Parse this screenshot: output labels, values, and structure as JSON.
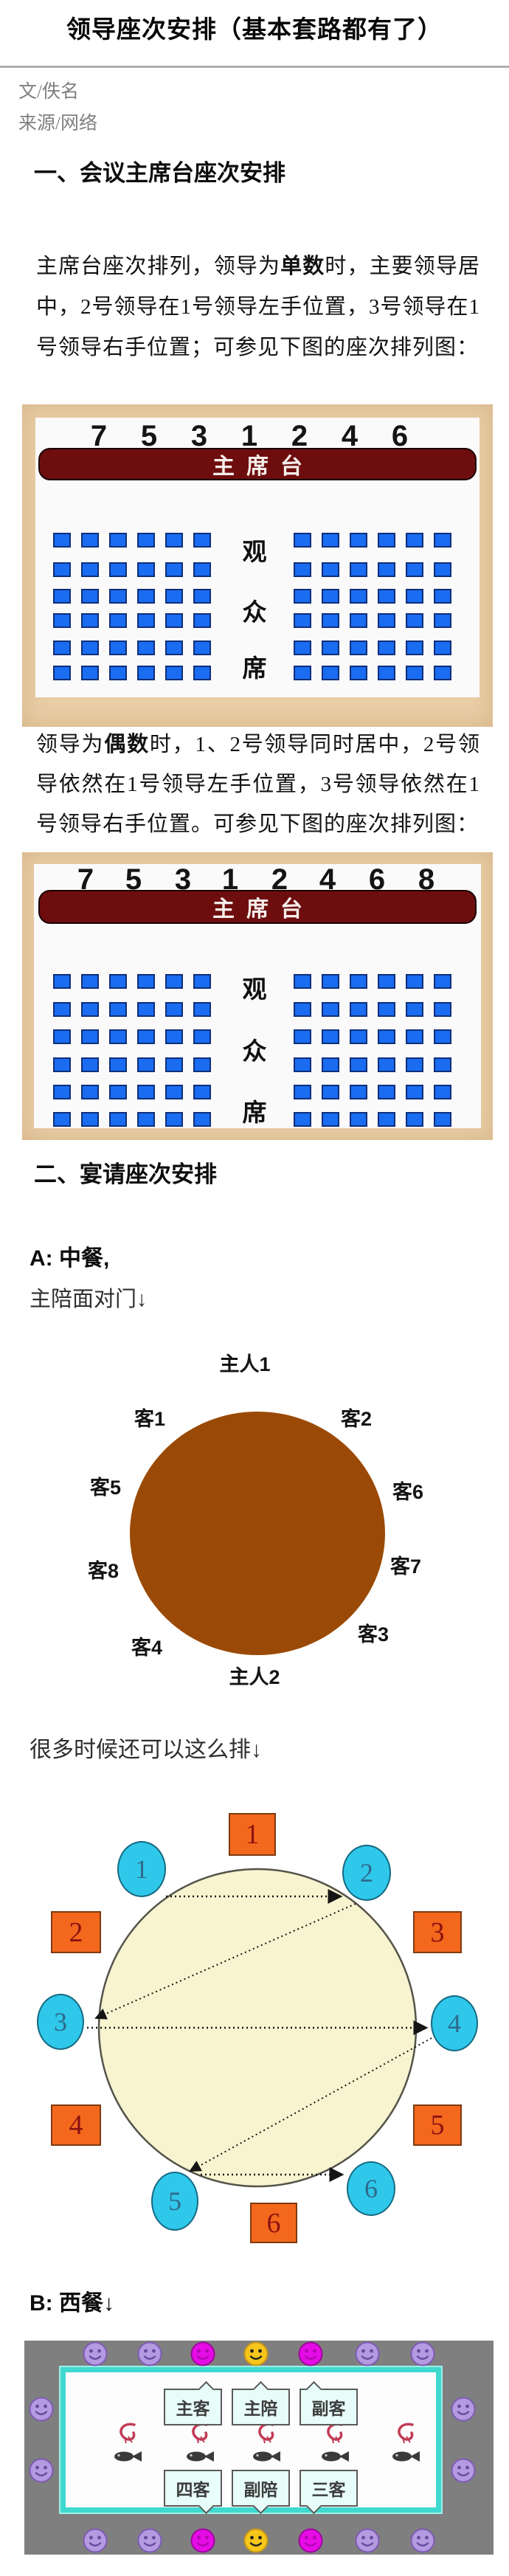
{
  "article": {
    "title": "领导座次安排（基本套路都有了）",
    "byline_author": "文/佚名",
    "byline_source": "来源/网络"
  },
  "section1": {
    "heading": "一、会议主席台座次安排",
    "para1": {
      "pre": "主席台座次排列，领导为",
      "bold": "单数",
      "post": "时，主要领导居中，2号领导在1号领导左手位置，3号领导在1号领导右手位置；可参见下图的座次排列图："
    },
    "para2": {
      "pre": "领导为",
      "bold": "偶数",
      "post": "时，1、2号领导同时居中，2号领导依然在1号领导左手位置，3号领导依然在1号领导右手位置。可参见下图的座次排列图："
    }
  },
  "podium_diagram_odd": {
    "numbers": [
      "7",
      "5",
      "3",
      "1",
      "2",
      "4",
      "6"
    ],
    "stage_label": "主席台",
    "audience_label": [
      "观",
      "众",
      "席"
    ],
    "seat_rows": 6,
    "seat_cols": 6
  },
  "podium_diagram_even": {
    "numbers": [
      "7",
      "5",
      "3",
      "1",
      "2",
      "4",
      "6",
      "8"
    ],
    "stage_label": "主席台",
    "audience_label": [
      "观",
      "众",
      "席"
    ],
    "seat_rows": 6,
    "seat_cols": 6
  },
  "section2": {
    "heading": "二、宴请座次安排",
    "label_a": "A: 中餐,",
    "label_a_note": "主陪面对门↓",
    "note_alt": "很多时候还可以这么排↓",
    "label_b": "B: 西餐↓"
  },
  "chinese_table": {
    "labels": {
      "host1": "主人1",
      "guest1": "客1",
      "guest2": "客2",
      "guest5": "客5",
      "guest6": "客6",
      "guest8": "客8",
      "guest7": "客7",
      "guest4": "客4",
      "guest3": "客3",
      "host2": "主人2"
    }
  },
  "alt_round_table": {
    "square_numbers": [
      "1",
      "2",
      "3",
      "4",
      "5",
      "6"
    ],
    "oval_numbers": [
      "1",
      "2",
      "3",
      "4",
      "5",
      "6"
    ]
  },
  "west_table": {
    "bubbles_top": [
      "主客",
      "主陪",
      "副客"
    ],
    "bubbles_bottom": [
      "四客",
      "副陪",
      "三客"
    ],
    "face_colors_top": [
      "purple",
      "purple",
      "magenta",
      "yellow",
      "magenta",
      "purple",
      "purple"
    ],
    "face_colors_bottom": [
      "purple",
      "purple",
      "magenta",
      "yellow",
      "magenta",
      "purple",
      "purple"
    ],
    "face_colors_side": [
      "purple",
      "purple",
      "purple",
      "purple"
    ],
    "food_sets": 5
  },
  "colors": {
    "frame_tan": "#e9cda5",
    "panel_white": "#fbfafa",
    "stage_red": "#6e0d0e",
    "seat_blue": "#1a6cf0",
    "seat_border": "#0f2f7a",
    "table_brown": "#9a4a06",
    "alt_table_yellow": "#f7f4cf",
    "square_orange": "#f4681d",
    "oval_cyan": "#2fc8ea",
    "west_bg_gray": "#7f7f7f",
    "teal_border": "#3fd9cf",
    "face_purple": "#b49ae0",
    "face_magenta": "#e50ce5",
    "face_yellow": "#f6c61b"
  }
}
